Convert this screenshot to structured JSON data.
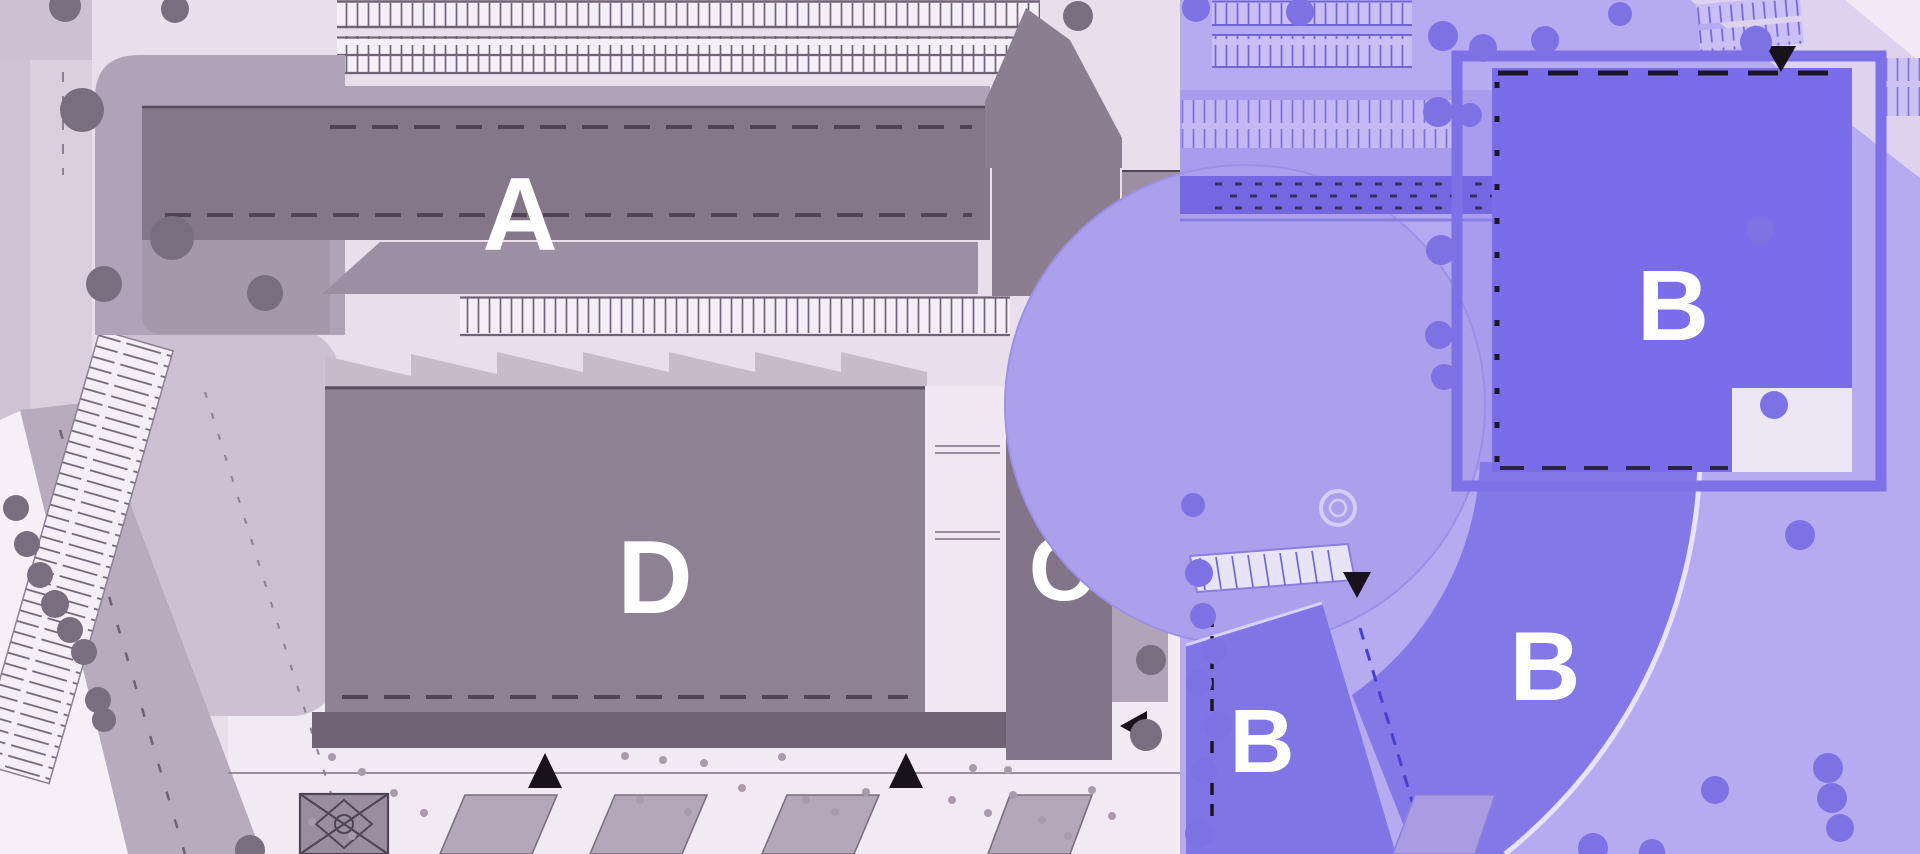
{
  "buildings": [
    {
      "id": "building-a",
      "label": "A"
    },
    {
      "id": "building-b-north",
      "label": "B"
    },
    {
      "id": "building-b-arc",
      "label": "B"
    },
    {
      "id": "building-b-south",
      "label": "B"
    },
    {
      "id": "building-c",
      "label": "C"
    },
    {
      "id": "building-d",
      "label": "D"
    }
  ],
  "zones": {
    "left_zone": "existing campus (gray)",
    "right_zone": "highlighted phase (blue)"
  },
  "colors": {
    "ground_light": "#e9dfec",
    "ground_white": "#f4edf6",
    "ground_lavender": "#cdc0d3",
    "road_gray": "#b9abbe",
    "apron_gray": "#b1a3b7",
    "building_gray": "#847789",
    "building_gray_light": "#9c8fa3",
    "building_dark_band": "#6f6375",
    "tree_gray": "#796d80",
    "overlay_blue": "#b6aaf0",
    "plaza_blue": "#aca0ed",
    "building_blue": "#7b6de9",
    "wing_blue": "#8478e9",
    "bridge_blue": "#7567e2",
    "frame_blue": "#7e70e6",
    "tree_blue": "#7e71e3",
    "marker_black": "#17121c",
    "label_white": "#ffffff"
  }
}
